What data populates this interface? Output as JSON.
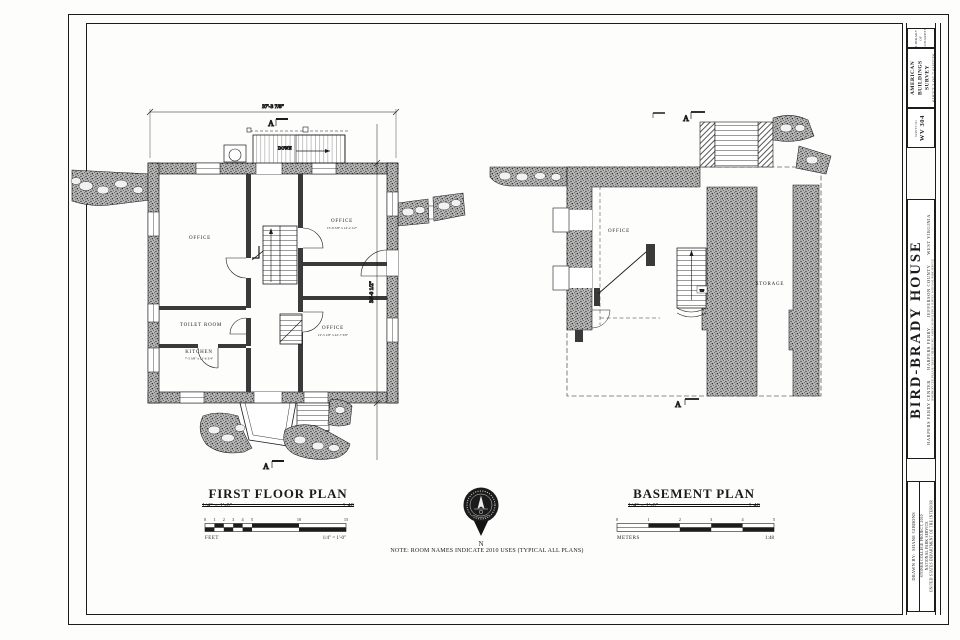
{
  "titleblock": {
    "corner_line1": "LIBRARY OF",
    "corner_line2": "CONGRESS",
    "survey_name_line1": "HISTORIC AMERICAN",
    "survey_name_line2": "BUILDINGS SURVEY",
    "sheet_info": "SHEET 2 OF 7 SHEETS",
    "survey_no_label": "SURVEY NO.",
    "survey_no": "WV 304",
    "credit_line": "IF REPRODUCED, PLEASE CREDIT THE HISTORIC AMERICAN BUILDINGS SURVEY, NATIONAL PARK SERVICE",
    "structure_name": "BIRD-BRADY HOUSE",
    "location": "HARPERS FERRY CENTER      HARPERS FERRY      JEFFERSON COUNTY      WEST VIRGINIA",
    "drawn_by": "DRAWN BY:  SHANE GIBBONS",
    "project_line1": "STONER COLLEGE PROJECT, 2010",
    "project_line2": "NATIONAL PARK SERVICE",
    "project_line3": "UNITED STATES DEPARTMENT OF THE INTERIOR"
  },
  "first_floor": {
    "title": "FIRST FLOOR PLAN",
    "scale_left": "1/4\" = 1'-0\"",
    "scale_right": "1:48",
    "dim_top": "37'-3 7/8\"",
    "dim_right": "34'-0 1/2\"",
    "room_office_nw": "OFFICE",
    "room_office_ne": "OFFICE",
    "room_office_ne_dims": "13'-9 5/8\" x 14'-2 1/2\"",
    "room_toilet": "TOILET ROOM",
    "room_kitchen": "KITCHEN",
    "room_kitchen_dims": "7'-5 3/8\" x 11'-6 3/4\"",
    "room_office_se": "OFFICE",
    "room_office_se_dims": "12'-5 1/8\" x 22'-7 3/8\"",
    "stair_down": "DOWN",
    "section_marker": "A"
  },
  "basement": {
    "title": "BASEMENT PLAN",
    "scale_left": "1/4\" = 1'-0\"",
    "scale_right": "1:48",
    "room_office": "OFFICE",
    "room_storage": "STORAGE",
    "stair_up": "UP",
    "section_marker": "A"
  },
  "scalebars": {
    "feet": {
      "n0": "0",
      "n1": "1",
      "n2": "2",
      "n3": "3",
      "n4": "4",
      "n5": "5",
      "n10": "10",
      "n15": "15",
      "unit": "FEET",
      "note": "1/4\" = 1'-0\""
    },
    "meters": {
      "m0": "0",
      "m1": "1",
      "m2": "2",
      "m3": "3",
      "m4": "4",
      "m5": "5",
      "unit": "METERS",
      "note": "1:48"
    }
  },
  "compass": {
    "north": "N"
  },
  "note": "NOTE:  ROOM NAMES INDICATE 2010 USES (TYPICAL ALL PLANS)"
}
